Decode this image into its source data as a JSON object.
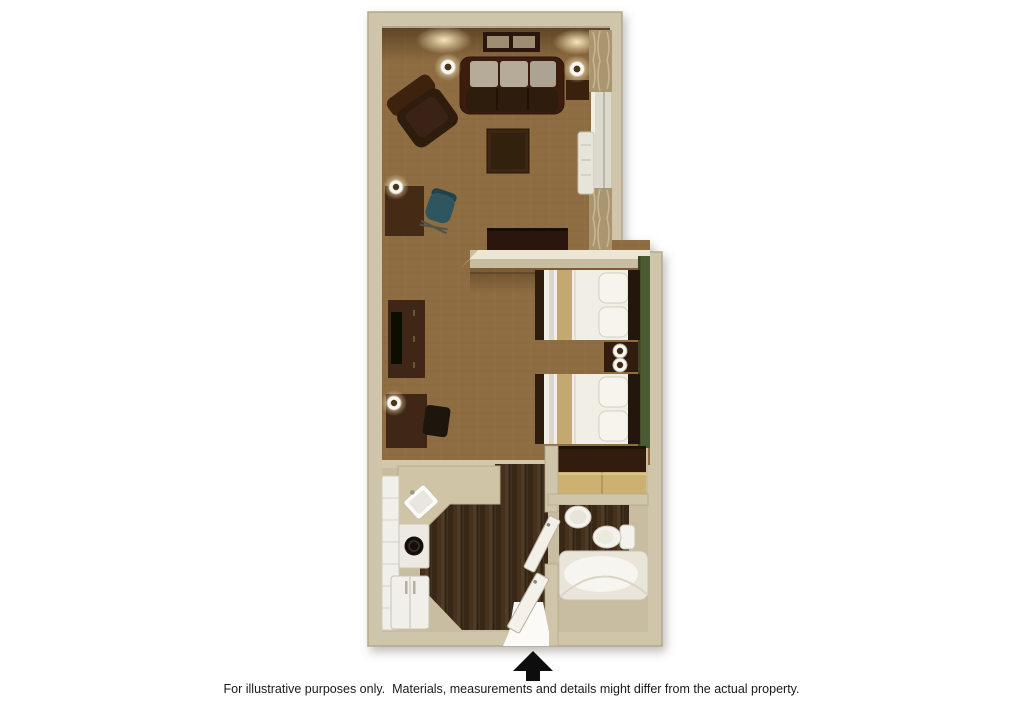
{
  "caption": "For illustrative purposes only.  Materials, measurements and details might differ from the actual property.",
  "colors": {
    "page_bg": "#ffffff",
    "caption_text": "#1a1a1a",
    "wall": "#cfc5ab",
    "wall_cap": "#ece6d5",
    "carpet": "#8f6d42",
    "wood_floor": "#44301f",
    "tile": "#c9bda1",
    "green_wall": "#4b5a32",
    "furniture_dark": "#3a2112",
    "furniture_darker": "#2a1708",
    "linen": "#f0eee5",
    "blanket": "#c3a96f",
    "counter": "#d0c4a7",
    "fixture_white": "#f3f2ec",
    "lamp_glow": "#ffeec2",
    "arrow": "#0d0d0d"
  }
}
